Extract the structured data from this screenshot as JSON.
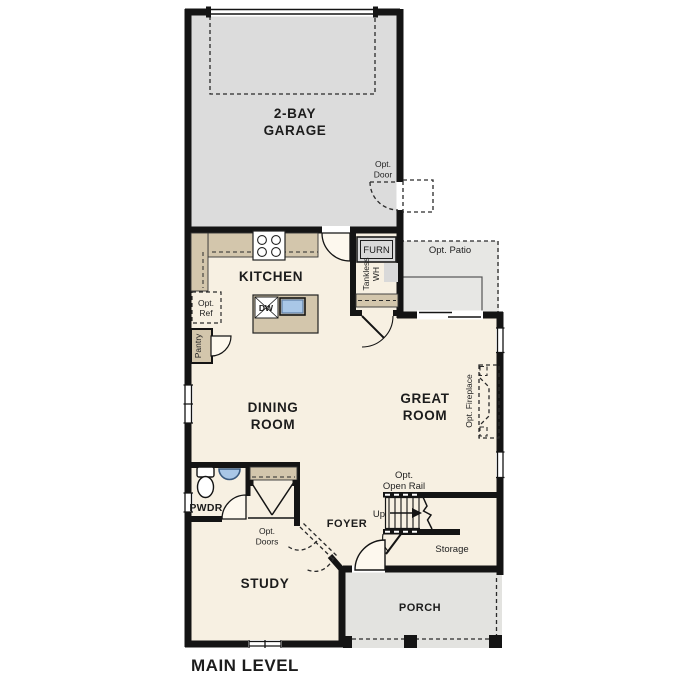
{
  "title": "MAIN LEVEL",
  "rooms": {
    "garage": {
      "line1": "2-BAY",
      "line2": "GARAGE"
    },
    "kitchen": {
      "label": "KITCHEN"
    },
    "dining": {
      "line1": "DINING",
      "line2": "ROOM"
    },
    "great_room": {
      "line1": "GREAT",
      "line2": "ROOM"
    },
    "foyer": {
      "label": "FOYER"
    },
    "study": {
      "label": "STUDY"
    },
    "pwdr": {
      "label": "PWDR"
    },
    "porch": {
      "label": "PORCH"
    },
    "storage": {
      "label": "Storage"
    }
  },
  "annotations": {
    "opt_door": {
      "line1": "Opt.",
      "line2": "Door"
    },
    "opt_patio": {
      "label": "Opt. Patio"
    },
    "opt_ref": {
      "line1": "Opt.",
      "line2": "Ref"
    },
    "pantry": {
      "label": "Pantry"
    },
    "furnace": {
      "label": "FURN"
    },
    "tankless": {
      "line1": "Tankless",
      "line2": "WH"
    },
    "opt_fireplace": {
      "label": "Opt. Fireplace"
    },
    "opt_open_rail": {
      "line1": "Opt.",
      "line2": "Open Rail"
    },
    "up": {
      "label": "Up"
    },
    "opt_doors": {
      "line1": "Opt.",
      "line2": "Doors"
    },
    "dishwasher": {
      "label": "DW"
    }
  },
  "colors": {
    "garage": "#dcdcdc",
    "floor": "#f7f0e2",
    "patio": "#e7e7e4",
    "porch": "#e3e3e0",
    "counter": "#d3c6ac",
    "appliance": "#d9d9d9",
    "fixture_blue": "#a9c7e7"
  }
}
